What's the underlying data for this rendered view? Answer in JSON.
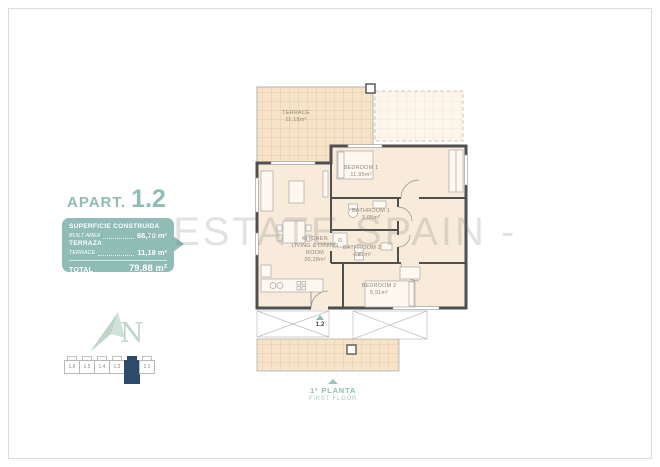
{
  "watermark": "- ESTATE SPAIN -",
  "info_panel": {
    "title_prefix": "APART.",
    "title_number": "1.2",
    "built_label_primary": "SUPERFICIE CONSTRUIDA",
    "built_label_secondary": "BUILT AREA",
    "built_value": "68,70 m²",
    "terrace_label_primary": "TERRAZA",
    "terrace_label_secondary": "TERRACE",
    "terrace_value": "11,18 m²",
    "total_label": "TOTAL",
    "total_value": "79,88 m²"
  },
  "floor_plan": {
    "rooms": {
      "terrace": {
        "name": "TERRACE",
        "area": "11,18m²"
      },
      "bedroom1": {
        "name": "BEDROOM 1",
        "area": "11,95m²"
      },
      "bathroom1": {
        "name": "BATHROOM 1",
        "area": "3,05m²"
      },
      "bathroom2": {
        "name": "BATHROOM 2",
        "area": "4,27m²"
      },
      "living": {
        "name_line1": "KITCHEN",
        "name_line2": "LIVING & DINING",
        "name_line3": "ROOM",
        "area": "30,28m²"
      },
      "bedroom2": {
        "name": "BEDROOM 2",
        "area": "9,91m²"
      }
    },
    "entrance_label": "1.2"
  },
  "compass": {
    "letter": "N"
  },
  "key_plan": {
    "units": [
      "1.6",
      "1.5",
      "1.4",
      "1.3",
      "1.2",
      "1.1"
    ],
    "highlighted_unit": "1.2"
  },
  "floor_label": {
    "line1": "1ª PLANTA",
    "line2": "FIRST FLOOR"
  },
  "colors": {
    "teal": "#8fbcb4",
    "teal_light": "#bcd6c9",
    "navy_highlight": "#2d4a6b",
    "room_fill": "#f8ebd9",
    "terrace_fill": "#f6e3c8",
    "terrace_grid": "#e2c39a",
    "wall": "#4f4f4f",
    "watermark_gray": "#d9d9d9"
  }
}
